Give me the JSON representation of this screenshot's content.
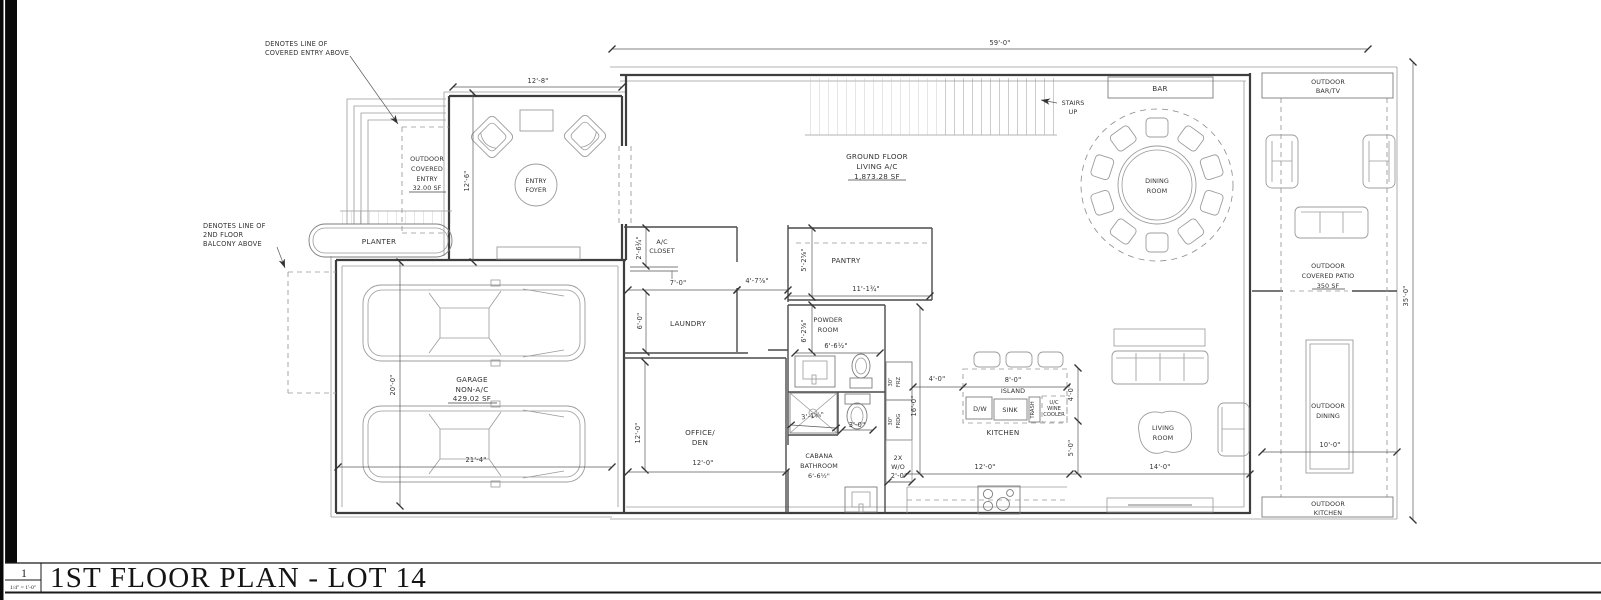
{
  "sheet": {
    "number": "1",
    "scale": "1/4\" = 1'-0\"",
    "title": "1ST FLOOR PLAN - LOT 14"
  },
  "notes": {
    "covered_entry": [
      "DENOTES LINE OF",
      "COVERED ENTRY ABOVE"
    ],
    "balcony": [
      "DENOTES LINE OF",
      "2ND FLOOR",
      "BALCONY ABOVE"
    ]
  },
  "rooms": {
    "outdoor_covered_entry": [
      "OUTDOOR",
      "COVERED",
      "ENTRY",
      "32.00 SF"
    ],
    "entry_foyer": [
      "ENTRY",
      "FOYER"
    ],
    "planter": "PLANTER",
    "garage": [
      "GARAGE",
      "NON-A/C",
      "429.02 SF"
    ],
    "ac_closet": [
      "A/C",
      "CLOSET"
    ],
    "laundry": "LAUNDRY",
    "pantry": "PANTRY",
    "powder_room": [
      "POWDER",
      "ROOM"
    ],
    "office_den": [
      "OFFICE/",
      "DEN"
    ],
    "cabana_bath": [
      "CABANA",
      "BATHROOM",
      "6'-6½\""
    ],
    "kitchen": "KITCHEN",
    "island": "ISLAND",
    "ground_floor": [
      "GROUND FLOOR",
      "LIVING A/C",
      "1,873.28 SF"
    ],
    "stairs": [
      "STAIRS",
      "UP"
    ],
    "bar": "BAR",
    "dining_room": [
      "DINING",
      "ROOM"
    ],
    "living_room": [
      "LIVING",
      "ROOM"
    ],
    "outdoor_bar_tv": [
      "OUTDOOR",
      "BAR/TV"
    ],
    "outdoor_patio": [
      "OUTDOOR",
      "COVERED PATIO",
      "350 SF"
    ],
    "outdoor_dining": [
      "OUTDOOR",
      "DINING"
    ],
    "outdoor_kitchen": [
      "OUTDOOR",
      "KITCHEN"
    ]
  },
  "appliances": {
    "frz": [
      "30\"",
      "FRZ"
    ],
    "frdg": [
      "30\"",
      "FRDG"
    ],
    "wall_ovens": [
      "2X",
      "W/O"
    ],
    "dw": "D/W",
    "sink": "SINK",
    "trash": "TRASH",
    "wine": [
      "U/C",
      "WINE",
      "COOLER"
    ]
  },
  "dims": {
    "house_width": "59'-0\"",
    "foyer_w": "12'-8\"",
    "foyer_h": "12'-6\"",
    "garage_h": "20'-0\"",
    "garage_w": "21'-4\"",
    "ac_closet_h": "2'-6¾\"",
    "closet_w": "7'-0\"",
    "laundry_h": "6'-0\"",
    "hall_w": "4'-7⅞\"",
    "pantry_h": "5'-2⅝\"",
    "pantry_w": "11'-1¾\"",
    "powder_h": "6'-2⅝\"",
    "powder_w": "6'-6½\"",
    "shower_w": "3'-1⅝\"",
    "wc_w": "3'-0\"",
    "office_h": "12'-0\"",
    "office_w": "12'-0\"",
    "oven_w": "2'-0\"",
    "kitchen_h": "16'-0\"",
    "island_gap": "4'-0\"",
    "island_w": "8'-0\"",
    "island_side": "4'-0\"",
    "living_gap": "5'-0\"",
    "kitchen_w": "12'-0\"",
    "living_w": "14'-0\"",
    "patio_w": "10'-0\"",
    "lot_depth": "35'-0\""
  }
}
